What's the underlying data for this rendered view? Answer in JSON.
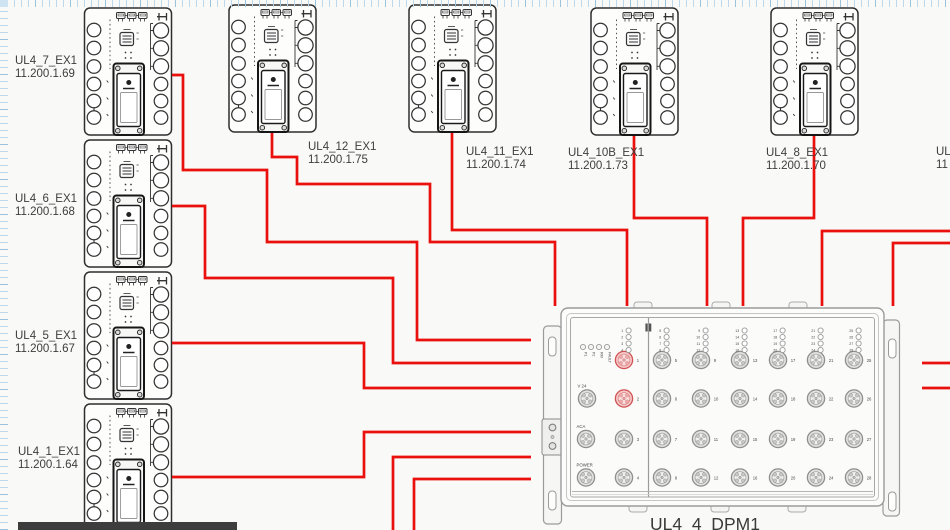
{
  "canvas": {
    "background": "#f9f9f7",
    "grid_tick_color": "#bcd8ea",
    "grid_tick_strong": "#9cc3de",
    "cable_color": "#e9100d",
    "device_outline_color": "#2e2e2e",
    "dpm_outline_color": "#9b9b9b",
    "highlight_port_color": "#d05252",
    "taskbar_color": "#3d3d3d"
  },
  "devices": [
    {
      "name": "UL4_7_EX1",
      "ip": "11.200.1.69",
      "shape": {
        "x": 83.5,
        "y": 7
      },
      "label": {
        "x": 15,
        "y": 55
      }
    },
    {
      "name": "UL4_6_EX1",
      "ip": "11.200.1.68",
      "shape": {
        "x": 83.5,
        "y": 139
      },
      "label": {
        "x": 15,
        "y": 193
      }
    },
    {
      "name": "UL4_5_EX1",
      "ip": "11.200.1.67",
      "shape": {
        "x": 83.5,
        "y": 271
      },
      "label": {
        "x": 15,
        "y": 330
      }
    },
    {
      "name": "UL4_1_EX1",
      "ip": "11.200.1.64",
      "shape": {
        "x": 83.5,
        "y": 403
      },
      "label": {
        "x": 18,
        "y": 446
      }
    },
    {
      "name": "UL4_12_EX1",
      "ip": "11.200.1.75",
      "shape": {
        "x": 228,
        "y": 4
      },
      "label": {
        "x": 308,
        "y": 141
      }
    },
    {
      "name": "UL4_11_EX1",
      "ip": "11.200.1.74",
      "shape": {
        "x": 408,
        "y": 4
      },
      "label": {
        "x": 466,
        "y": 146
      }
    },
    {
      "name": "UL4_10B_EX1",
      "ip": "11.200.1.73",
      "shape": {
        "x": 590,
        "y": 7
      },
      "label": {
        "x": 568,
        "y": 147
      }
    },
    {
      "name": "UL4_8_EX1",
      "ip": "11.200.1.70",
      "shape": {
        "x": 770,
        "y": 7
      },
      "label": {
        "x": 766,
        "y": 147
      }
    }
  ],
  "offscreen_device_label": {
    "line1": "UL",
    "line2": "11",
    "x": 936,
    "y": 146
  },
  "dpm": {
    "title": "UL4_4_DPM1",
    "status_leds": [
      "P1",
      "P2",
      "RM",
      "FAULT"
    ],
    "status_led_xs": [
      583,
      591,
      599,
      607
    ],
    "status_led_y": 347,
    "aux_ports": [
      {
        "label": "V 24",
        "x": 587,
        "y": 398.5
      },
      {
        "label": "ACA",
        "x": 586,
        "y": 439
      },
      {
        "label": "POWER",
        "x": 586,
        "y": 477.5
      }
    ],
    "port_columns": [
      {
        "x": 624,
        "ports": [
          1,
          2,
          3,
          4
        ]
      },
      {
        "x": 662,
        "ports": [
          5,
          6,
          7,
          8
        ]
      },
      {
        "x": 701,
        "ports": [
          9,
          10,
          11,
          12
        ]
      },
      {
        "x": 740,
        "ports": [
          13,
          14,
          15,
          16
        ]
      },
      {
        "x": 778,
        "ports": [
          17,
          18,
          19,
          20
        ]
      },
      {
        "x": 816,
        "ports": [
          21,
          22,
          23,
          24
        ]
      },
      {
        "x": 854,
        "ports": [
          25,
          26,
          27,
          28
        ]
      }
    ],
    "row_y": [
      360,
      398.5,
      439,
      477.5
    ],
    "led_row_y": [
      330.5,
      337,
      343.5,
      350
    ],
    "highlighted_ports": [
      1,
      2
    ]
  },
  "cables": [
    {
      "id": "ul4_7_to_dpm",
      "points": [
        [
          172,
          75
        ],
        [
          183,
          75
        ],
        [
          183,
          170
        ],
        [
          267,
          170
        ],
        [
          267,
          242
        ],
        [
          417,
          242
        ],
        [
          417,
          340
        ],
        [
          531,
          340
        ]
      ]
    },
    {
      "id": "ul4_6_to_dpm",
      "points": [
        [
          172,
          206
        ],
        [
          205,
          206
        ],
        [
          205,
          278
        ],
        [
          393,
          278
        ],
        [
          393,
          363
        ],
        [
          531,
          363
        ]
      ]
    },
    {
      "id": "ul4_5_to_dpm",
      "points": [
        [
          172,
          343
        ],
        [
          364,
          343
        ],
        [
          364,
          388
        ],
        [
          531,
          388
        ]
      ]
    },
    {
      "id": "ul4_1_to_dpm",
      "points": [
        [
          172,
          477
        ],
        [
          364,
          477
        ],
        [
          364,
          432
        ],
        [
          531,
          432
        ]
      ]
    },
    {
      "id": "offscreen_bottom_1",
      "points": [
        [
          393,
          531
        ],
        [
          393,
          457
        ],
        [
          531,
          457
        ]
      ]
    },
    {
      "id": "offscreen_bottom_2",
      "points": [
        [
          414,
          531
        ],
        [
          414,
          479
        ],
        [
          531,
          479
        ]
      ]
    },
    {
      "id": "ul4_12_to_dpm",
      "points": [
        [
          272,
          133
        ],
        [
          272,
          157
        ],
        [
          297,
          157
        ],
        [
          297,
          184
        ],
        [
          430,
          184
        ],
        [
          430,
          242
        ],
        [
          555,
          242
        ],
        [
          555,
          306
        ]
      ]
    },
    {
      "id": "ul4_11_to_dpm",
      "points": [
        [
          452,
          133
        ],
        [
          452,
          230
        ],
        [
          627,
          230
        ],
        [
          627,
          306
        ]
      ]
    },
    {
      "id": "ul4_10b_to_dpm",
      "points": [
        [
          634,
          136
        ],
        [
          634,
          218
        ],
        [
          707,
          218
        ],
        [
          707,
          306
        ]
      ]
    },
    {
      "id": "ul4_8_to_dpm",
      "points": [
        [
          814,
          136
        ],
        [
          814,
          218
        ],
        [
          743,
          218
        ],
        [
          743,
          306
        ]
      ]
    },
    {
      "id": "offscreen_right_1",
      "points": [
        [
          951,
          231
        ],
        [
          822,
          231
        ],
        [
          822,
          306
        ]
      ]
    },
    {
      "id": "offscreen_right_2",
      "points": [
        [
          951,
          243
        ],
        [
          893,
          243
        ],
        [
          893,
          306
        ]
      ]
    },
    {
      "id": "stub_right_1",
      "points": [
        [
          922,
          363
        ],
        [
          951,
          363
        ]
      ]
    },
    {
      "id": "stub_right_2",
      "points": [
        [
          922,
          388
        ],
        [
          951,
          388
        ]
      ]
    }
  ]
}
